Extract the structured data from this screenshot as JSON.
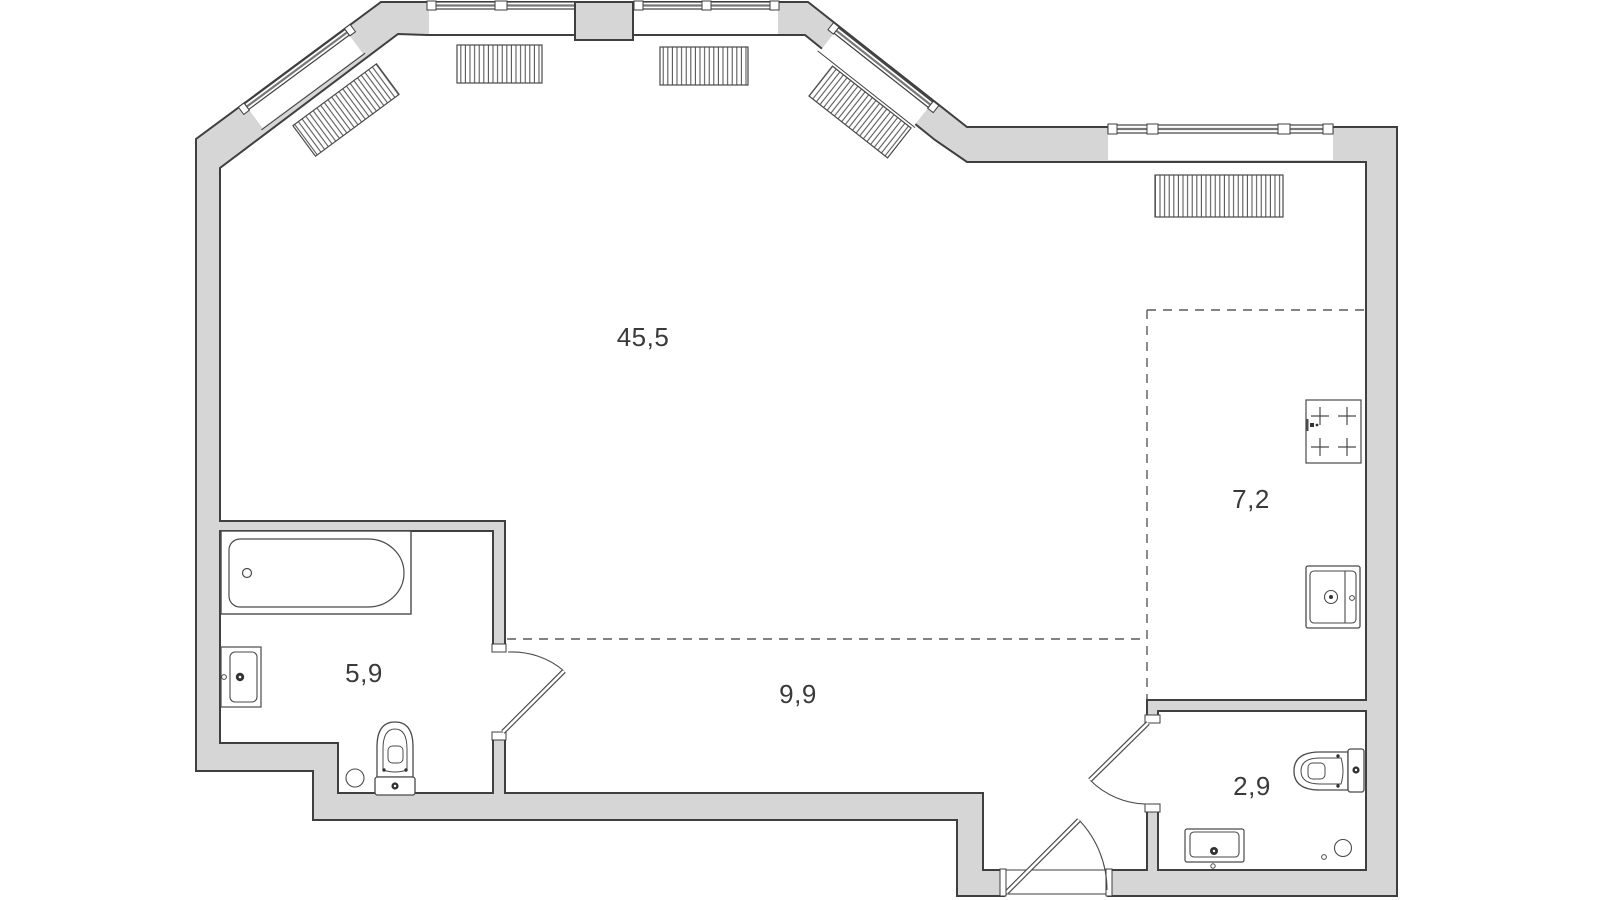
{
  "floorplan": {
    "title": "apartment-floor-plan",
    "rooms": [
      {
        "id": "living-room",
        "area_label": "45,5"
      },
      {
        "id": "kitchen",
        "area_label": "7,2"
      },
      {
        "id": "bathroom",
        "area_label": "5,9"
      },
      {
        "id": "hallway",
        "area_label": "9,9"
      },
      {
        "id": "wc",
        "area_label": "2,9"
      }
    ],
    "fixtures": {
      "bathroom": [
        "bathtub",
        "washbasin",
        "toilet",
        "floor-drain"
      ],
      "kitchen": [
        "stove-4-burner",
        "kitchen-sink"
      ],
      "wc": [
        "toilet",
        "washbasin",
        "floor-drain"
      ]
    },
    "radiators_count": 5,
    "windows": [
      "left-diagonal-bay-window",
      "top-window-left",
      "top-window-right",
      "right-top-window"
    ],
    "doors": [
      "bathroom-door",
      "wc-door",
      "entrance-door"
    ],
    "zone_boundaries": [
      "kitchen-dashed-zone",
      "hallway-dashed-zone"
    ],
    "colors": {
      "wall_fill": "#d6d6d6",
      "wall_outline": "#3f3f3f",
      "fixture_outline": "#4a4a4a",
      "background": "#ffffff",
      "dashed_zone": "#5a5a5a",
      "label_text": "#3a3a3a"
    }
  }
}
